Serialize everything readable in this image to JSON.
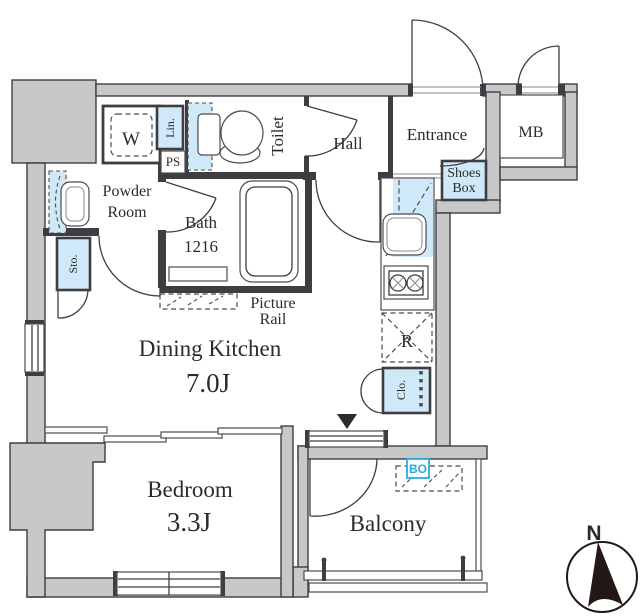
{
  "colors": {
    "wall_fill": "#c7c8ca",
    "outline": "#3e3e42",
    "fixture_blue": "#cfe9f8",
    "accent_blue": "#29abe2",
    "text": "#2b2b2e"
  },
  "rooms": {
    "dining_kitchen": {
      "name": "Dining Kitchen",
      "size": "7.0J"
    },
    "bedroom": {
      "name": "Bedroom",
      "size": "3.3J"
    },
    "balcony": {
      "name": "Balcony"
    },
    "hall": {
      "name": "Hall"
    },
    "entrance": {
      "name": "Entrance"
    },
    "toilet": {
      "name": "Toilet"
    },
    "powder_room": {
      "line1": "Powder",
      "line2": "Room"
    },
    "bath": {
      "name": "Bath",
      "size": "1216"
    }
  },
  "labels": {
    "washer": "W",
    "linen": "Lin.",
    "pipe_space": "PS",
    "meter_box": "MB",
    "shoes_box_line1": "Shoes",
    "shoes_box_line2": "Box",
    "storage": "Sto.",
    "refrigerator": "R",
    "closet": "Clo.",
    "balcony_bo": "BO",
    "picture_rail_line1": "Picture",
    "picture_rail_line2": "Rail",
    "north": "N"
  }
}
